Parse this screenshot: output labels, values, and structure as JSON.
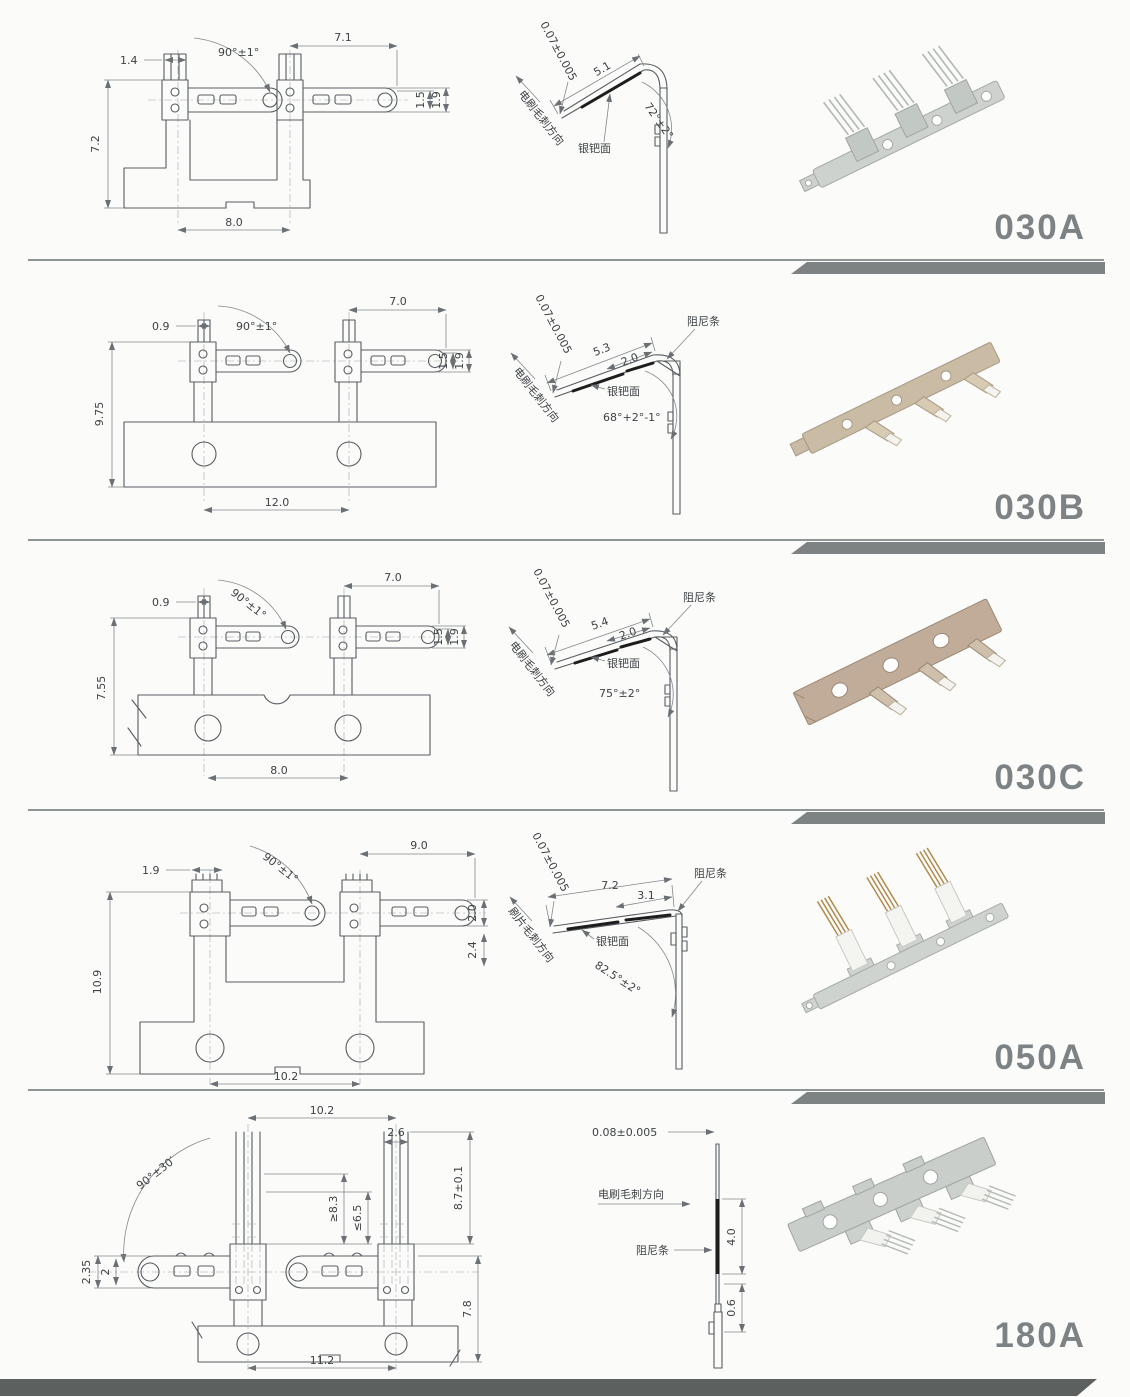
{
  "page": {
    "background": "#fbfbfa",
    "divider_color": "#7d8383",
    "bottom_bar_color": "#5c615f",
    "model_label_color": "#7d8285"
  },
  "rows": [
    {
      "model": "030A",
      "front": {
        "pitch": "1.4",
        "angle": "90°±1°",
        "arm_length": "7.1",
        "height": "7.2",
        "base_width": "8.0",
        "tip_inner": "1.5",
        "tip_outer": "1.9"
      },
      "side": {
        "thickness": "0.07±0.005",
        "burr_direction": "电刷毛刺方向",
        "arm_length": "5.1",
        "bend_angle": "72°±2°",
        "contact_surface": "银钯面"
      },
      "photo": {
        "finish": "silver"
      }
    },
    {
      "model": "030B",
      "front": {
        "pitch": "0.9",
        "angle": "90°±1°",
        "arm_length": "7.0",
        "height": "9.75",
        "base_width": "12.0",
        "tip_inner": "1.5",
        "tip_outer": "1.9"
      },
      "side": {
        "thickness": "0.07±0.005",
        "burr_direction": "电刷毛刺方向",
        "arm_length": "5.3",
        "damper_offset": "2.0",
        "damper_label": "阻尼条",
        "bend_angle": "68°+2°-1°",
        "contact_surface": "银钯面"
      },
      "photo": {
        "finish": "brass"
      }
    },
    {
      "model": "030C",
      "front": {
        "pitch": "0.9",
        "angle": "90°±1°",
        "arm_length": "7.0",
        "height": "7.55",
        "base_width": "8.0",
        "tip_inner": "1.5",
        "tip_outer": "1.9"
      },
      "side": {
        "thickness": "0.07±0.005",
        "burr_direction": "电刷毛刺方向",
        "arm_length": "5.4",
        "damper_offset": "2.0",
        "damper_label": "阻尼条",
        "bend_angle": "75°±2°",
        "contact_surface": "银钯面"
      },
      "photo": {
        "finish": "bronze"
      }
    },
    {
      "model": "050A",
      "front": {
        "pitch": "1.9",
        "angle": "90°±1°",
        "arm_length": "9.0",
        "height": "10.9",
        "base_width": "10.2",
        "tip_inner": "2.0",
        "tip_outer": "2.4"
      },
      "side": {
        "thickness": "0.07±0.005",
        "burr_direction": "刷片毛刺方向",
        "arm_length": "7.2",
        "damper_offset": "3.1",
        "damper_label": "阻尼条",
        "bend_angle": "82.5°±2°",
        "contact_surface": "银钯面"
      },
      "photo": {
        "finish": "silver-gold"
      }
    },
    {
      "model": "180A",
      "front": {
        "span": "10.2",
        "pitch": "2.6",
        "angle": "90°±30′",
        "free_length": "≥8.3",
        "clamp_length": "≤6.5",
        "brush_length": "8.7±0.1",
        "tip_outer": "2.35",
        "tip_inner": "2",
        "height": "7.8",
        "base_width": "11.2"
      },
      "side": {
        "thickness": "0.08±0.005",
        "burr_direction": "电刷毛刺方向",
        "damper_label": "阻尼条",
        "damper_length": "4.0",
        "tail_length": "0.6"
      },
      "photo": {
        "finish": "silver-white"
      }
    }
  ]
}
